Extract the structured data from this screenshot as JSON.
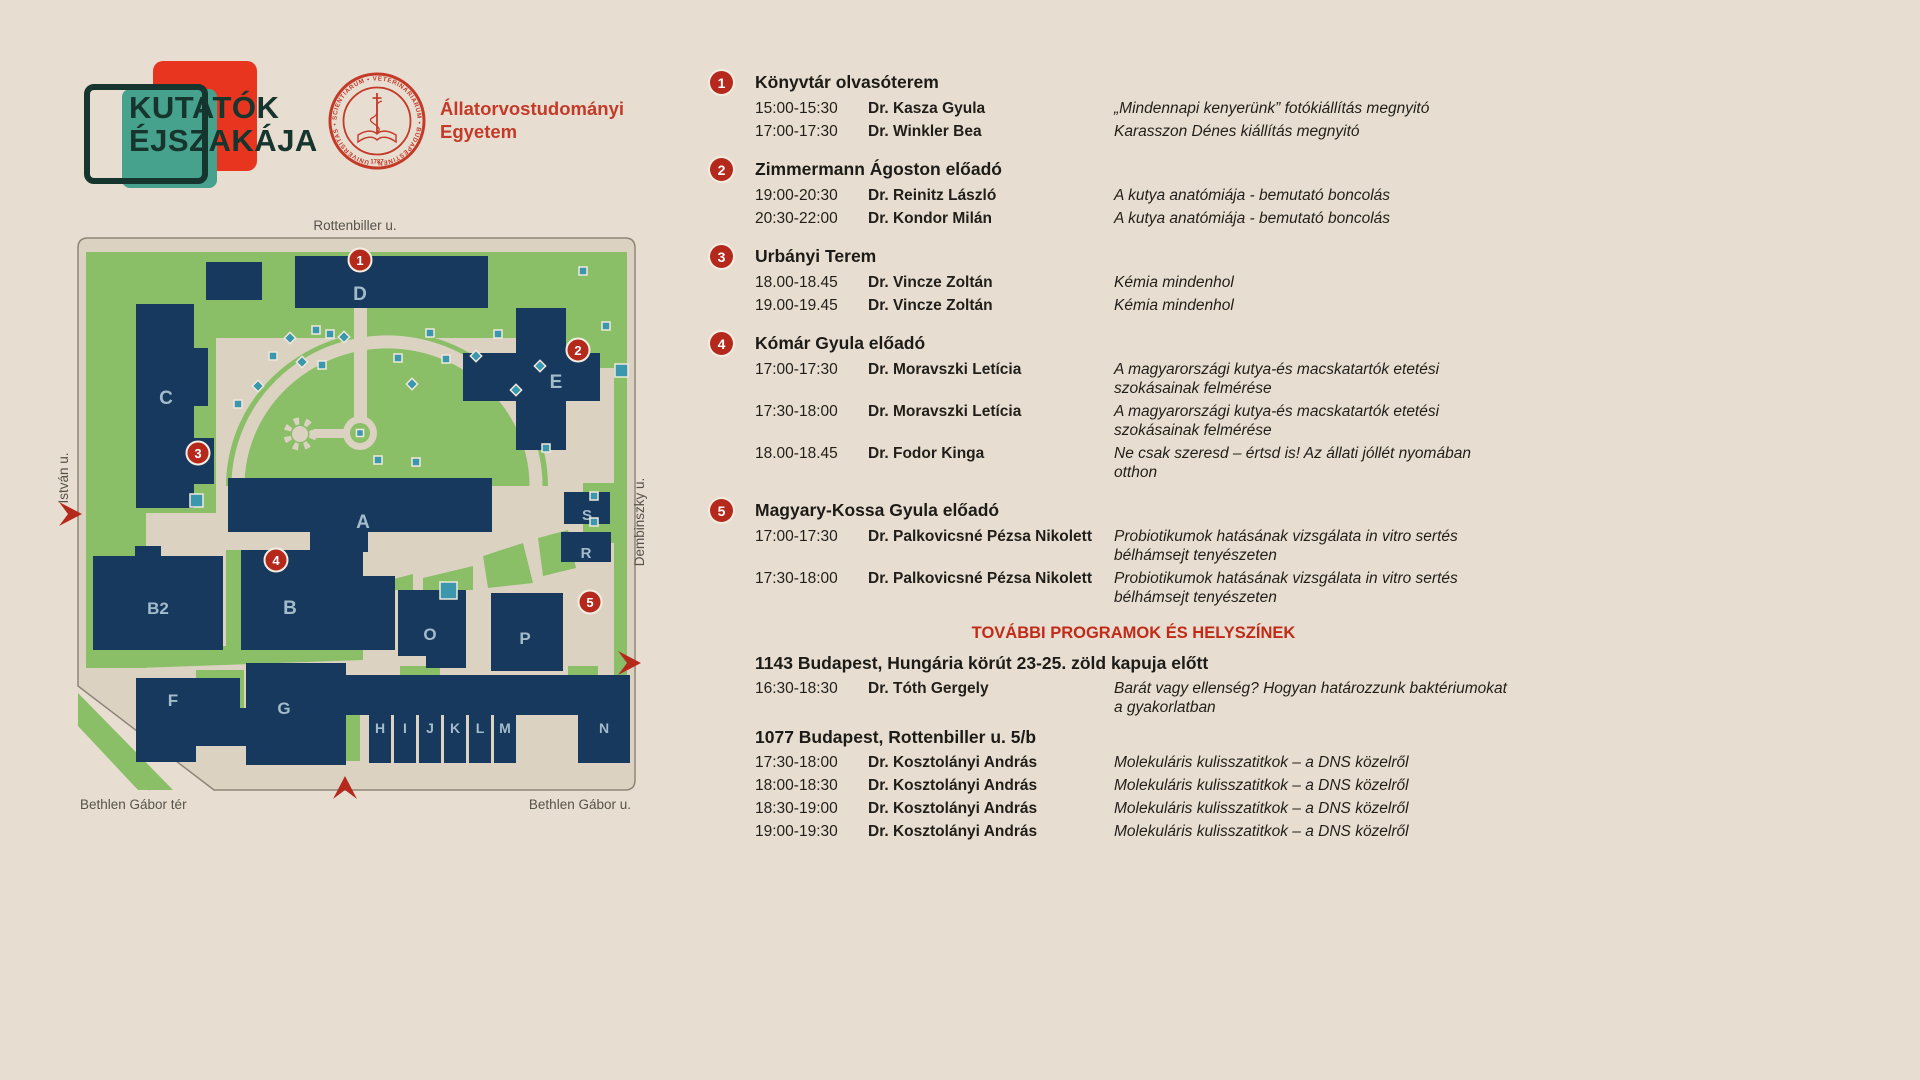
{
  "logo": {
    "line1": "KUTATÓK",
    "line2": "ÉJSZAKÁJA"
  },
  "university": {
    "name_line1": "Állatorvostudományi",
    "name_line2": "Egyetem",
    "seal_ring_text": "UNIVERSITAS • SCIENTIARUM • VETERINARIARUM • BUDAPESTINENSIS",
    "seal_year": "1787"
  },
  "map": {
    "street_labels": {
      "top": "Rottenbiller u.",
      "left": "István u.",
      "right": "Dembinszky u.",
      "bottom_left": "Bethlen Gábor tér",
      "bottom_right": "Bethlen Gábor u."
    },
    "building_labels": {
      "a": "A",
      "b": "B",
      "b2": "B2",
      "c": "C",
      "d": "D",
      "e": "E",
      "f": "F",
      "g": "G",
      "h": "H",
      "i": "I",
      "j": "J",
      "k": "K",
      "l": "L",
      "m": "M",
      "n": "N",
      "o": "O",
      "p": "P",
      "r": "R",
      "s": "S"
    },
    "markers": [
      "1",
      "2",
      "3",
      "4",
      "5"
    ]
  },
  "schedule": {
    "venues": [
      {
        "num": "1",
        "name": "Könyvtár olvasóterem",
        "events": [
          {
            "time": "15:00-15:30",
            "speaker": "Dr. Kasza Gyula",
            "title": "„Mindennapi kenyerünk” fotókiállítás megnyitó"
          },
          {
            "time": "17:00-17:30",
            "speaker": "Dr. Winkler Bea",
            "title": "Karasszon Dénes kiállítás megnyitó"
          }
        ]
      },
      {
        "num": "2",
        "name": "Zimmermann Ágoston előadó",
        "events": [
          {
            "time": "19:00-20:30",
            "speaker": "Dr. Reinitz László",
            "title": "A kutya anatómiája - bemutató boncolás"
          },
          {
            "time": "20:30-22:00",
            "speaker": "Dr. Kondor Milán",
            "title": "A kutya anatómiája - bemutató boncolás"
          }
        ]
      },
      {
        "num": "3",
        "name": "Urbányi Terem",
        "events": [
          {
            "time": "18.00-18.45",
            "speaker": "Dr. Vincze Zoltán",
            "title": "Kémia mindenhol"
          },
          {
            "time": "19.00-19.45",
            "speaker": "Dr. Vincze Zoltán",
            "title": "Kémia mindenhol"
          }
        ]
      },
      {
        "num": "4",
        "name": "Kómár Gyula előadó",
        "events": [
          {
            "time": "17:00-17:30",
            "speaker": "Dr. Moravszki Letícia",
            "title": "A magyarországi kutya-és macskatartók etetési szokásainak felmérése"
          },
          {
            "time": "17:30-18:00",
            "speaker": "Dr. Moravszki Letícia",
            "title": "A magyarországi kutya-és macskatartók etetési szokásainak felmérése"
          },
          {
            "time": "18.00-18.45",
            "speaker": "Dr. Fodor Kinga",
            "title": "Ne csak szeresd – értsd is! Az állati jóllét nyomában otthon"
          }
        ]
      },
      {
        "num": "5",
        "name": "Magyary-Kossa Gyula előadó",
        "events": [
          {
            "time": "17:00-17:30",
            "speaker": "Dr. Palkovicsné Pézsa Nikolett",
            "title": "Probiotikumok hatásának vizsgálata in vitro sertés bélhámsejt tenyészeten"
          },
          {
            "time": "17:30-18:00",
            "speaker": "Dr. Palkovicsné Pézsa Nikolett",
            "title": "Probiotikumok hatásának vizsgálata in vitro sertés bélhámsejt tenyészeten"
          }
        ]
      }
    ],
    "more_heading": "TOVÁBBI PROGRAMOK ÉS HELYSZÍNEK",
    "more_locations": [
      {
        "name": "1143 Budapest, Hungária körút 23-25. zöld kapuja előtt",
        "events": [
          {
            "time": "16:30-18:30",
            "speaker": "Dr. Tóth Gergely",
            "title": "Barát vagy ellenség? Hogyan határozzunk baktériumokat a gyakorlatban"
          }
        ]
      },
      {
        "name": "1077 Budapest, Rottenbiller u. 5/b",
        "events": [
          {
            "time": "17:30-18:00",
            "speaker": "Dr. Kosztolányi András",
            "title": "Molekuláris kulisszatitkok – a DNS közelről"
          },
          {
            "time": "18:00-18:30",
            "speaker": "Dr. Kosztolányi András",
            "title": "Molekuláris kulisszatitkok – a DNS közelről"
          },
          {
            "time": "18:30-19:00",
            "speaker": "Dr. Kosztolányi András",
            "title": "Molekuláris kulisszatitkok – a DNS közelről"
          },
          {
            "time": "19:00-19:30",
            "speaker": "Dr. Kosztolányi András",
            "title": "Molekuláris kulisszatitkok – a DNS közelről"
          }
        ]
      }
    ]
  }
}
